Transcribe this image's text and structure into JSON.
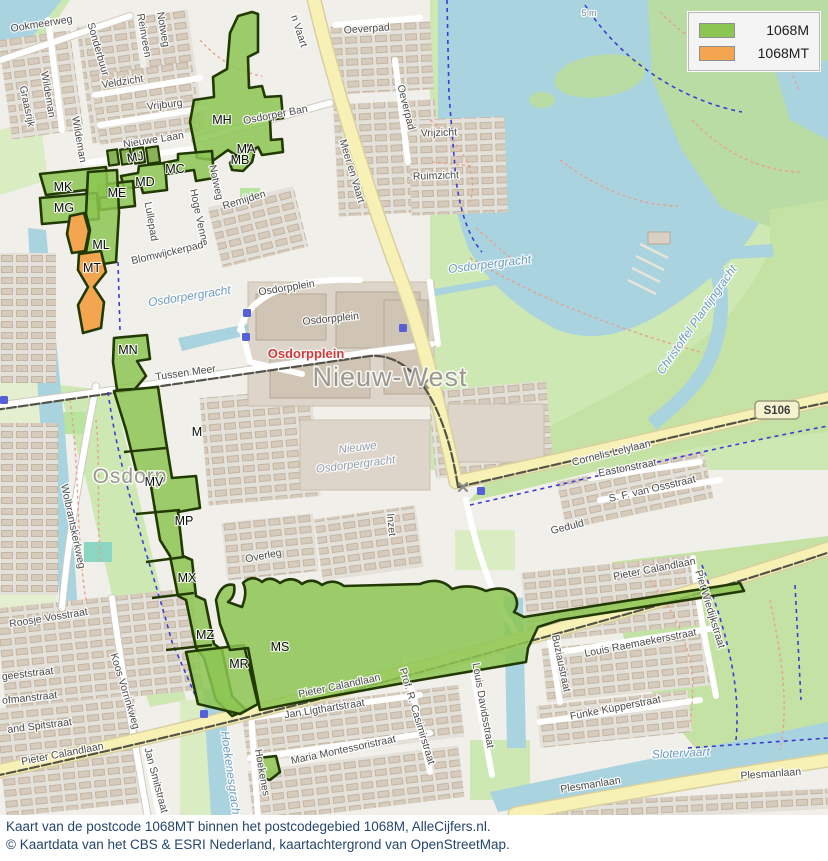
{
  "legend": {
    "items": [
      {
        "label": "1068M",
        "color": "#8cc652"
      },
      {
        "label": "1068MT",
        "color": "#f3a64f"
      }
    ]
  },
  "caption": {
    "line1": "Kaart van de postcode 1068MT binnen het postcodegebied 1068M, AlleCijfers.nl.",
    "line2": "© Kaartdata van het CBS & ESRI Nederland, kaartachtergrond van OpenStreetMap."
  },
  "colors": {
    "pc_green": "#8cc652",
    "pc_orange": "#f3a64f",
    "pc_border": "#223a02",
    "water": "#a9d3df",
    "land": "#f1efe9",
    "grass": "#cde8b2",
    "road_yellow": "#f7f1b5",
    "caption_text": "#25456e"
  },
  "map": {
    "labels": [
      {
        "t": "Ookmeerweg",
        "x": 42,
        "y": 27,
        "r": -9,
        "c": "st"
      },
      {
        "t": "Sonderbuur",
        "x": 95,
        "y": 50,
        "r": 74,
        "c": "st"
      },
      {
        "t": "Wildeman",
        "x": 45,
        "y": 95,
        "r": 80,
        "c": "st"
      },
      {
        "t": "Wildeman",
        "x": 76,
        "y": 140,
        "r": 80,
        "c": "st"
      },
      {
        "t": "Graasrijk",
        "x": 24,
        "y": 107,
        "r": 78,
        "c": "st"
      },
      {
        "t": "Reinveen",
        "x": 141,
        "y": 36,
        "r": 80,
        "c": "st"
      },
      {
        "t": "Notweg",
        "x": 160,
        "y": 30,
        "r": 80,
        "c": "st"
      },
      {
        "t": "Veldzicht",
        "x": 123,
        "y": 85,
        "r": -9,
        "c": "st"
      },
      {
        "t": "Vrijburg",
        "x": 165,
        "y": 108,
        "r": -7,
        "c": "st"
      },
      {
        "t": "Nieuwe Laan",
        "x": 154,
        "y": 143,
        "r": -9,
        "c": "st"
      },
      {
        "t": "Oeverpad",
        "x": 367,
        "y": 32,
        "r": -4,
        "c": "st"
      },
      {
        "t": "Oeverpad",
        "x": 403,
        "y": 108,
        "r": 76,
        "c": "st"
      },
      {
        "t": "Osdorper Ban",
        "x": 276,
        "y": 118,
        "r": -11,
        "c": "st"
      },
      {
        "t": "Meer en Vaart",
        "x": 349,
        "y": 172,
        "r": 73,
        "c": "st",
        "s": 12
      },
      {
        "t": "n Vaart",
        "x": 296,
        "y": 32,
        "r": 72,
        "c": "st",
        "s": 12
      },
      {
        "t": "Vrijzicht",
        "x": 439,
        "y": 136,
        "r": -2,
        "c": "st"
      },
      {
        "t": "Ruimzicht",
        "x": 436,
        "y": 179,
        "r": -2,
        "c": "st"
      },
      {
        "t": "Remijden",
        "x": 245,
        "y": 203,
        "r": -17,
        "c": "st"
      },
      {
        "t": "Notweg",
        "x": 213,
        "y": 183,
        "r": 78,
        "c": "st"
      },
      {
        "t": "Hoge Venne",
        "x": 196,
        "y": 218,
        "r": 78,
        "c": "st"
      },
      {
        "t": "Lullepad",
        "x": 148,
        "y": 222,
        "r": 80,
        "c": "st"
      },
      {
        "t": "Blomwijckerpad",
        "x": 168,
        "y": 256,
        "r": -13,
        "c": "st"
      },
      {
        "t": "Osdorpplein",
        "x": 287,
        "y": 291,
        "r": -9,
        "c": "st"
      },
      {
        "t": "Osdorpplein",
        "x": 331,
        "y": 322,
        "r": -6,
        "c": "st"
      },
      {
        "t": "Tussen Meer",
        "x": 186,
        "y": 376,
        "r": -8,
        "c": "st",
        "s": 11
      },
      {
        "t": "Wolbrantskerkweg",
        "x": 70,
        "y": 527,
        "r": 78,
        "c": "st"
      },
      {
        "t": "Inzet",
        "x": 388,
        "y": 525,
        "r": 85,
        "c": "st"
      },
      {
        "t": "Geduld",
        "x": 568,
        "y": 530,
        "r": -14,
        "c": "st"
      },
      {
        "t": "Overleg",
        "x": 264,
        "y": 559,
        "r": -11,
        "c": "st"
      },
      {
        "t": "Eastonstraat",
        "x": 628,
        "y": 471,
        "r": -11,
        "c": "st",
        "s": 9.5
      },
      {
        "t": "S. F. van Ossstraat",
        "x": 653,
        "y": 492,
        "r": -13,
        "c": "st",
        "s": 9.5
      },
      {
        "t": "Cornelis Lelylaan",
        "x": 612,
        "y": 456,
        "r": -14,
        "c": "st",
        "s": 12.5
      },
      {
        "t": "Pieter Calandlaan",
        "x": 655,
        "y": 572,
        "r": -11,
        "c": "st",
        "s": 12
      },
      {
        "t": "Piet Wiedijkstraat",
        "x": 707,
        "y": 610,
        "r": 73,
        "c": "st",
        "s": 9.5
      },
      {
        "t": "Louis Raemaekersstraat",
        "x": 641,
        "y": 646,
        "r": -11,
        "c": "st",
        "s": 9.5
      },
      {
        "t": "Buziaustraat",
        "x": 558,
        "y": 664,
        "r": 78,
        "c": "st",
        "s": 9.5
      },
      {
        "t": "Funke Küpperstraat",
        "x": 616,
        "y": 711,
        "r": -11,
        "c": "st"
      },
      {
        "t": "Plesmanlaan",
        "x": 591,
        "y": 788,
        "r": -9,
        "c": "st",
        "s": 12.5
      },
      {
        "t": "Plesmanlaan",
        "x": 771,
        "y": 777,
        "r": -4,
        "c": "st",
        "s": 12.5
      },
      {
        "t": "Pieter Calandlaan",
        "x": 340,
        "y": 689,
        "r": -12,
        "c": "st",
        "s": 12
      },
      {
        "t": "Jan Ligthartstraat",
        "x": 325,
        "y": 712,
        "r": -9,
        "c": "st"
      },
      {
        "t": "Maria Montessoristraat",
        "x": 344,
        "y": 753,
        "r": -12,
        "c": "st"
      },
      {
        "t": "Hoekenes",
        "x": 259,
        "y": 773,
        "r": 80,
        "c": "st",
        "s": 10
      },
      {
        "t": "Prof. R. Casimirstraat",
        "x": 414,
        "y": 717,
        "r": 73,
        "c": "st",
        "s": 9.5
      },
      {
        "t": "Louis Davidsstraat",
        "x": 480,
        "y": 706,
        "r": 80,
        "c": "st",
        "s": 9.5
      },
      {
        "t": "Koos Vorrinkweg",
        "x": 122,
        "y": 692,
        "r": 73,
        "c": "st",
        "s": 10
      },
      {
        "t": "Jan Smitstraat",
        "x": 153,
        "y": 781,
        "r": 75,
        "c": "st",
        "s": 10
      },
      {
        "t": "Roosje Vosstraat",
        "x": 49,
        "y": 621,
        "r": -9,
        "c": "st",
        "s": 10
      },
      {
        "t": "geeststraat",
        "x": 28,
        "y": 677,
        "r": -7,
        "c": "st",
        "s": 10
      },
      {
        "t": "ofmanstraat",
        "x": 30,
        "y": 701,
        "r": -6,
        "c": "st",
        "s": 10
      },
      {
        "t": "and Spitstraat",
        "x": 40,
        "y": 729,
        "r": -7,
        "c": "st",
        "s": 10
      },
      {
        "t": "Pieter Calandlaan",
        "x": 63,
        "y": 757,
        "r": -11,
        "c": "st",
        "s": 12
      },
      {
        "t": "5 m",
        "x": 589,
        "y": 16,
        "r": 0,
        "c": "min"
      },
      {
        "t": "Osdorpergracht",
        "x": 190,
        "y": 300,
        "r": -9,
        "c": "wt"
      },
      {
        "t": "Osdorpergracht",
        "x": 490,
        "y": 268,
        "r": -7,
        "c": "wt"
      },
      {
        "t": "Slotervaart",
        "x": 681,
        "y": 757,
        "r": -3,
        "c": "wt"
      },
      {
        "t": "Christoffel Plantijngracht",
        "x": 700,
        "y": 322,
        "r": -55,
        "c": "wt",
        "s": 11
      },
      {
        "t": "Hoekenesgracht",
        "x": 227,
        "y": 775,
        "r": 82,
        "c": "wt",
        "s": 10
      },
      {
        "t": "Nieuwe",
        "x": 358,
        "y": 451,
        "r": -7,
        "c": "git"
      },
      {
        "t": "Osdorpergracht",
        "x": 356,
        "y": 468,
        "r": -7,
        "c": "git"
      },
      {
        "t": "Nieuw-West",
        "x": 390,
        "y": 386,
        "r": 0,
        "c": "pl2"
      },
      {
        "t": "Osdorp",
        "x": 130,
        "y": 483,
        "r": 0,
        "c": "pl"
      },
      {
        "t": "Osdorpplein",
        "x": 306,
        "y": 358,
        "r": 0,
        "c": "poi"
      },
      {
        "t": "MH",
        "x": 222,
        "y": 124,
        "r": 0,
        "c": "ar"
      },
      {
        "t": "MA",
        "x": 246,
        "y": 153,
        "r": 0,
        "c": "ar",
        "s": 11
      },
      {
        "t": "MB",
        "x": 240,
        "y": 164,
        "r": 0,
        "c": "ar",
        "s": 11
      },
      {
        "t": "MC",
        "x": 175,
        "y": 173,
        "r": 0,
        "c": "ar"
      },
      {
        "t": "MD",
        "x": 145,
        "y": 186,
        "r": 0,
        "c": "ar"
      },
      {
        "t": "MJ",
        "x": 136,
        "y": 161,
        "r": -10,
        "c": "ar",
        "s": 10
      },
      {
        "t": "ME",
        "x": 117,
        "y": 197,
        "r": 0,
        "c": "ar"
      },
      {
        "t": "MK",
        "x": 63,
        "y": 191,
        "r": 0,
        "c": "ar"
      },
      {
        "t": "MG",
        "x": 64,
        "y": 212,
        "r": 0,
        "c": "ar"
      },
      {
        "t": "ML",
        "x": 101,
        "y": 249,
        "r": 0,
        "c": "ar"
      },
      {
        "t": "MT",
        "x": 92,
        "y": 272,
        "r": 0,
        "c": "ar"
      },
      {
        "t": "MN",
        "x": 128,
        "y": 354,
        "r": 0,
        "c": "ar"
      },
      {
        "t": "M",
        "x": 197,
        "y": 436,
        "r": 0,
        "c": "ar"
      },
      {
        "t": "MV",
        "x": 154,
        "y": 486,
        "r": 0,
        "c": "ar"
      },
      {
        "t": "MP",
        "x": 184,
        "y": 525,
        "r": 0,
        "c": "ar"
      },
      {
        "t": "MX",
        "x": 187,
        "y": 582,
        "r": 0,
        "c": "ar"
      },
      {
        "t": "MZ",
        "x": 205,
        "y": 639,
        "r": 0,
        "c": "ar"
      },
      {
        "t": "MR",
        "x": 239,
        "y": 668,
        "r": 0,
        "c": "ar"
      },
      {
        "t": "MS",
        "x": 280,
        "y": 651,
        "r": 0,
        "c": "ar"
      },
      {
        "t": "S106",
        "x": 777,
        "y": 414,
        "r": 0,
        "c": "sh"
      }
    ]
  }
}
